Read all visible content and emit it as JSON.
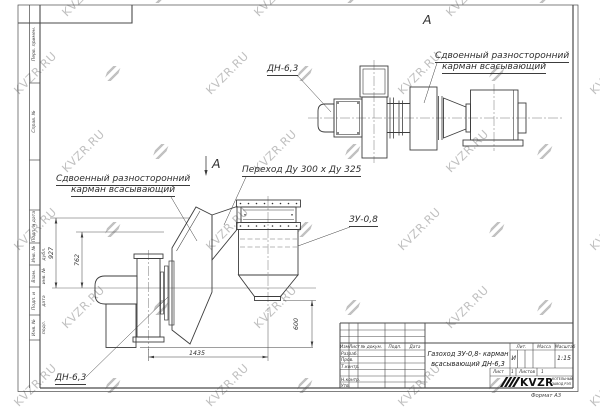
{
  "watermark": {
    "text": "KVZR.RU"
  },
  "left_stamp": {
    "top_cells": [
      "Перв. примен.",
      "Справ. №"
    ],
    "bottom_cells": [
      "Подп. и дата",
      "Инв. № дубл.",
      "Взам. инв. №",
      "Подп. и дата",
      "Инв. № подл."
    ]
  },
  "views": {
    "view_a_label": "А",
    "section_arrow_label": "А"
  },
  "labels": {
    "fan_top": "ДН-6,3",
    "fan_side": "ДН-6,3",
    "pocket_top_line1": "Сдвоенный разносторонний",
    "pocket_top_line2": "карман всасывающий",
    "pocket_side_line1": "Сдвоенный разносторонний",
    "pocket_side_line2": "карман всасывающий",
    "transition": "Переход Ду  300 х  Ду 325",
    "ash_unit": "ЗУ-0,8"
  },
  "dimensions": {
    "v927": "927",
    "v762": "762",
    "h1435": "1435",
    "v600": "600"
  },
  "title_block": {
    "title_line1": "Газоход ЗУ-0,8- карман",
    "title_line2": "всасывающий ДН-6,3",
    "cols": [
      "Изм.",
      "Лист",
      "№ докум.",
      "Подп.",
      "Дата"
    ],
    "sign_rows": [
      "Разраб.",
      "Пров.",
      "Т.контр.",
      "Н.контр.",
      "Утв."
    ],
    "lit_label": "Лит.",
    "lit_value": "И",
    "mass_label": "Масса",
    "scale_label": "Масштаб",
    "scale_value": "1:15",
    "sheet_label": "Лист",
    "sheet_value": "1",
    "sheets_label": "Листов",
    "sheets_value": "1",
    "brand": "KVZR",
    "brand_line1": "КОТЕЛЬНЫЙ",
    "brand_line2": "ЗАВОД РЭП",
    "format_note": "Формат  А3"
  }
}
